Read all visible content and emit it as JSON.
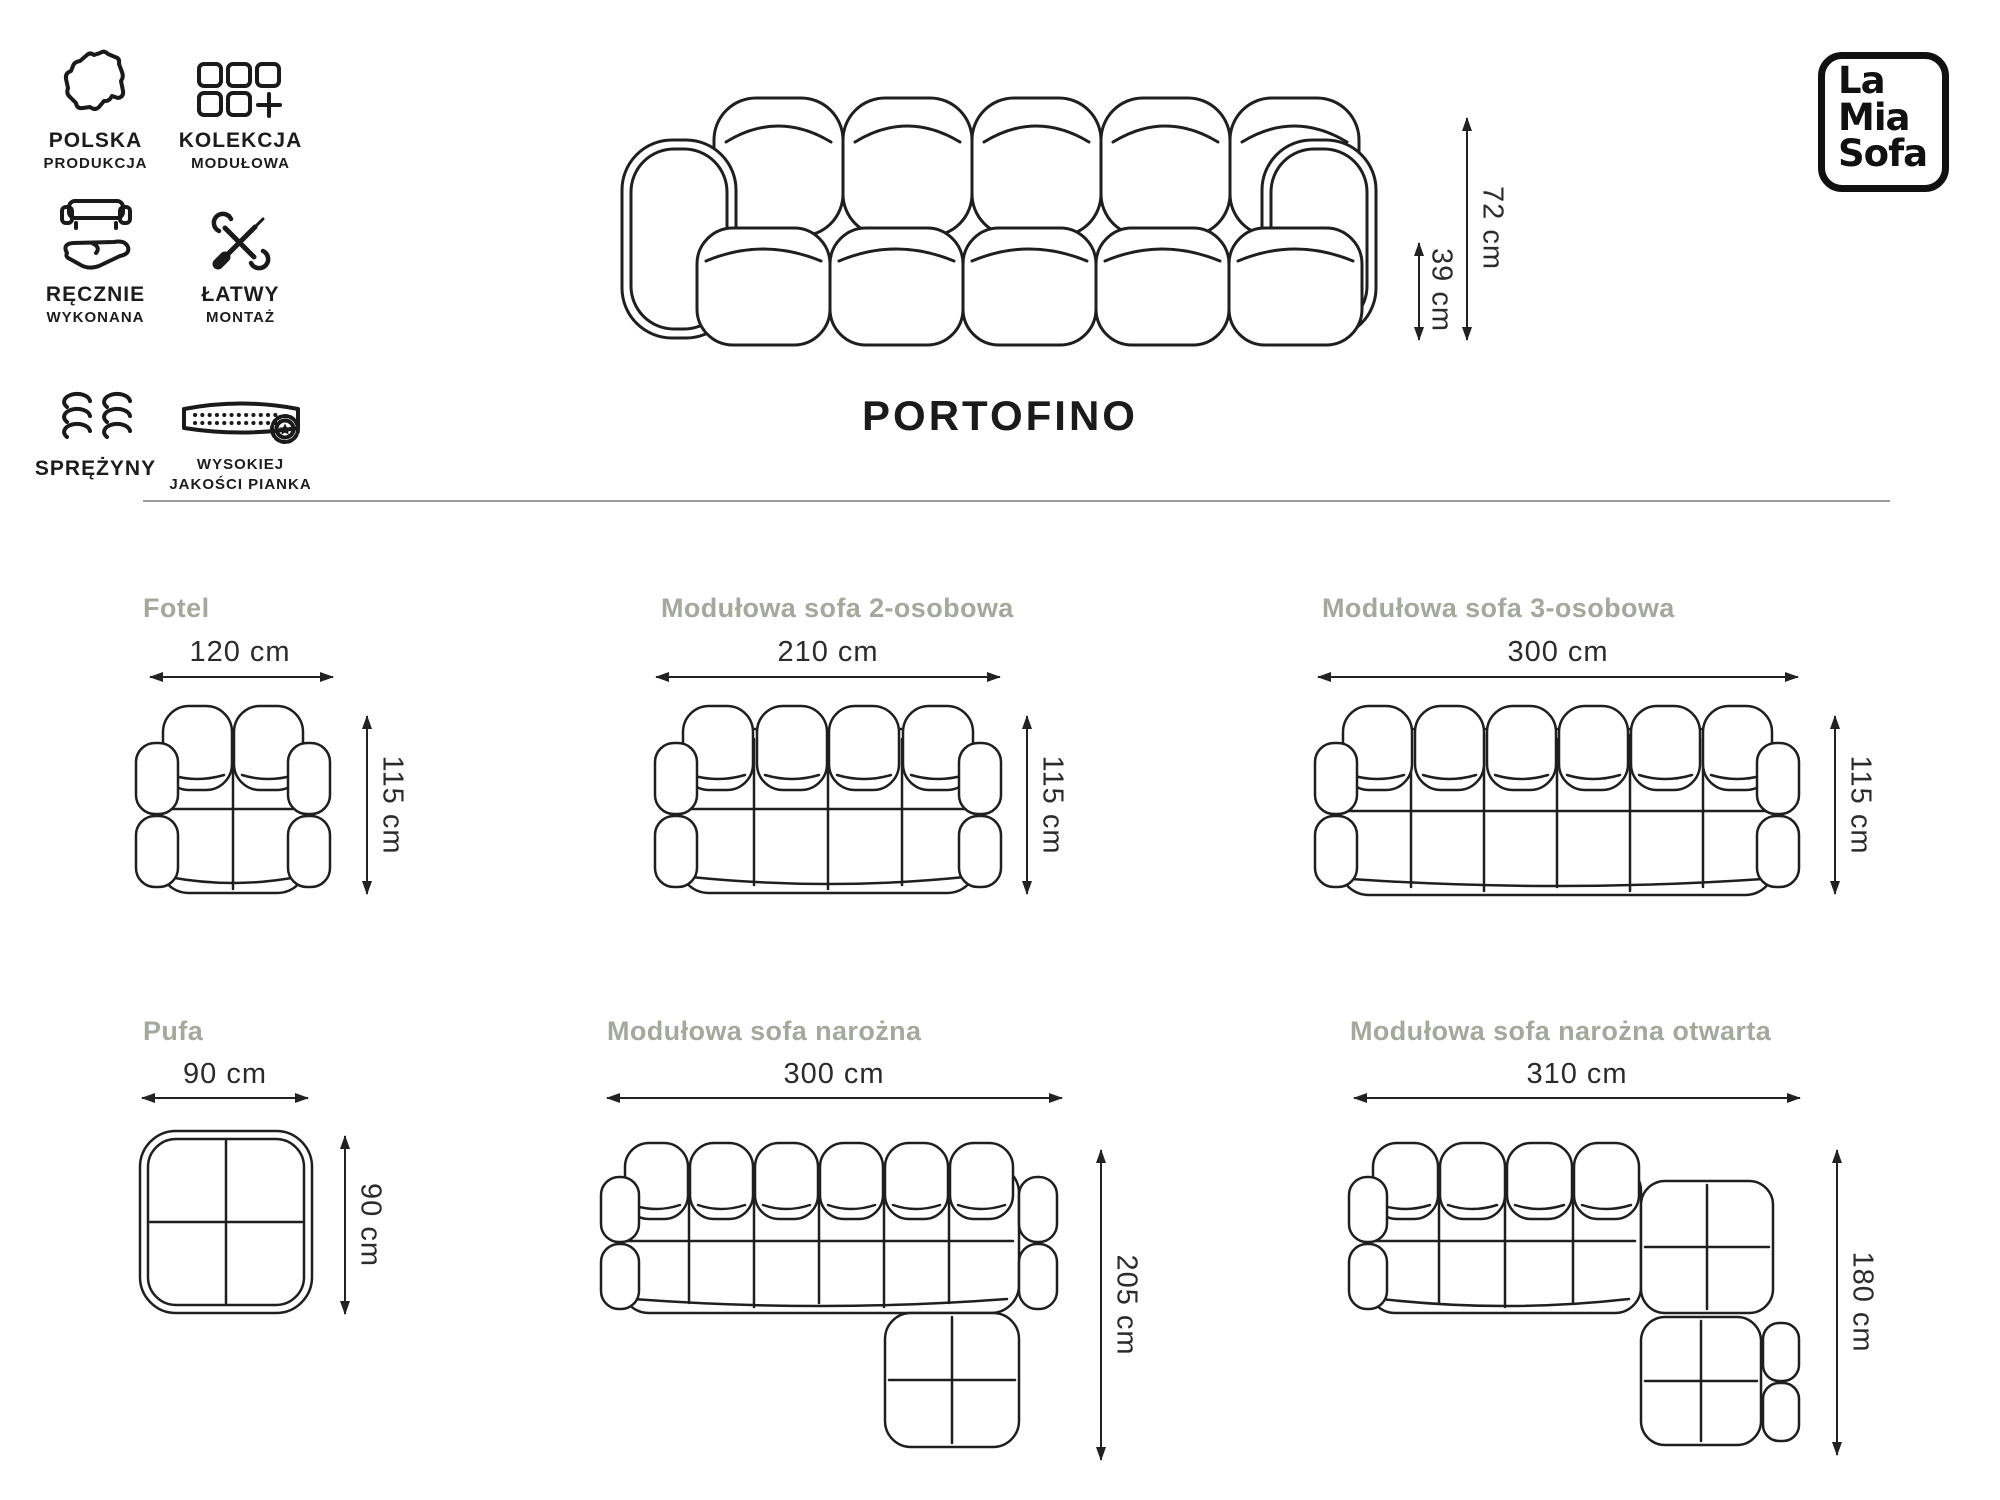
{
  "page": {
    "title": "PORTOFINO"
  },
  "logo": {
    "line1": "La",
    "line2": "Mia",
    "line3": "Sofa"
  },
  "features": [
    {
      "icon": "poland-map-icon",
      "line1": "POLSKA",
      "line2": "PRODUKCJA"
    },
    {
      "icon": "modular-collection-icon",
      "line1": "KOLEKCJA",
      "line2": "MODUŁOWA"
    },
    {
      "icon": "handmade-icon",
      "line1": "RĘCZNIE",
      "line2": "WYKONANA"
    },
    {
      "icon": "easy-assembly-icon",
      "line1": "ŁATWY",
      "line2": "MONTAŻ"
    },
    {
      "icon": "springs-icon",
      "line1": "SPRĘŻYNY",
      "line2": ""
    },
    {
      "icon": "foam-quality-icon",
      "line1": "WYSOKIEJ",
      "line2": "JAKOŚCI PIANKA"
    }
  ],
  "side_view": {
    "total_height": "72 cm",
    "seat_height": "39 cm"
  },
  "variants": [
    {
      "name": "Fotel",
      "width": "120 cm",
      "depth": "115 cm"
    },
    {
      "name": "Modułowa sofa 2-osobowa",
      "width": "210 cm",
      "depth": "115 cm"
    },
    {
      "name": "Modułowa sofa 3-osobowa",
      "width": "300 cm",
      "depth": "115 cm"
    },
    {
      "name": "Pufa",
      "width": "90 cm",
      "depth": "90 cm"
    },
    {
      "name": "Modułowa sofa narożna",
      "width": "300 cm",
      "depth": "205 cm"
    },
    {
      "name": "Modułowa sofa narożna otwarta",
      "width": "310 cm",
      "depth": "180 cm"
    }
  ],
  "colors": {
    "line": "#1f1f1f",
    "label_gray": "#a5a89c",
    "dim_text": "#2b2b2b",
    "divider": "#9c9c9c",
    "background": "#ffffff"
  }
}
